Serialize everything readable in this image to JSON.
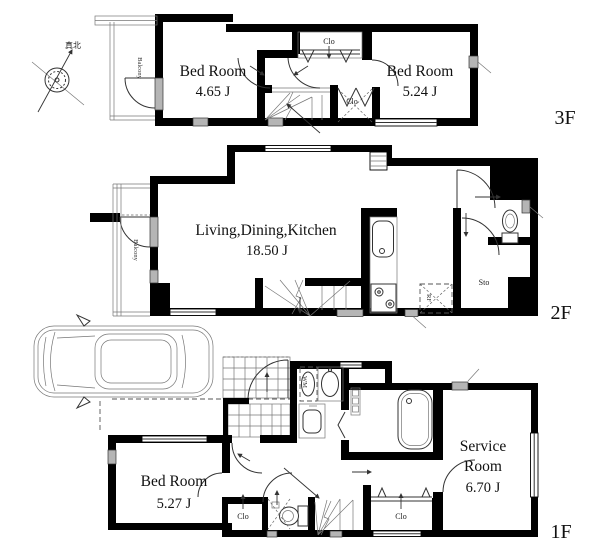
{
  "compass": {
    "label": "真北"
  },
  "floor3": {
    "label": "3F",
    "bed_left": {
      "name": "Bed Room",
      "area": "4.65 J"
    },
    "bed_right": {
      "name": "Bed Room",
      "area": "5.24 J"
    },
    "closet_top": "Clo",
    "closet_mid": "Clo",
    "balcony": "Balcony"
  },
  "floor2": {
    "label": "2F",
    "ldk": {
      "name": "Living,Dining,Kitchen",
      "area": "18.50 J"
    },
    "balcony": "Balcony",
    "storage": "Sto",
    "refrigerator": "RF"
  },
  "floor1": {
    "label": "1F",
    "bedroom": {
      "name": "Bed Room",
      "area": "5.27 J"
    },
    "service_room": {
      "line1": "Service",
      "line2": "Room",
      "area": "6.70 J"
    },
    "closet_hall": "Clo",
    "closet_back": "Clo",
    "washing_machine": "WM"
  },
  "colors": {
    "wall": "#000000",
    "line": "#3a3a3a",
    "window_gray": "#b5b5b5",
    "background": "#ffffff",
    "text": "#111111"
  }
}
